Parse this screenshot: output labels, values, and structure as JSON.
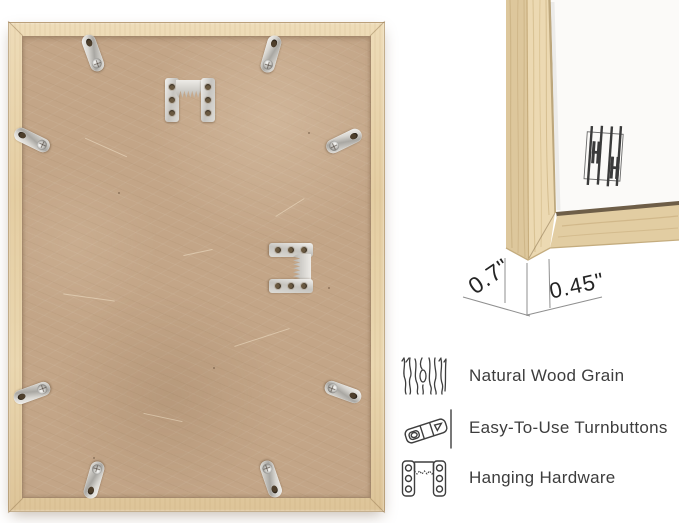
{
  "dimensions": {
    "depth": "0.7\"",
    "face_width": "0.45\""
  },
  "features": [
    {
      "icon": "wood-grain-icon",
      "label": "Natural Wood Grain"
    },
    {
      "icon": "turnbutton-icon",
      "label": "Easy-To-Use Turnbuttons"
    },
    {
      "icon": "hanging-hardware-icon",
      "label": "Hanging Hardware"
    }
  ],
  "hardware": {
    "turnbutton_count": 8,
    "sawtooth_hanger_count": 2
  },
  "colors": {
    "wood_light": "#ecd9b2",
    "wood_mid": "#e2cb9f",
    "wood_streak": "#c9ac79",
    "backing": "#c3a587",
    "metal": "#d6d4cf",
    "label_text": "#3d3d3d",
    "dimension_text": "#242424",
    "annotation_line": "#8f8f8f"
  }
}
